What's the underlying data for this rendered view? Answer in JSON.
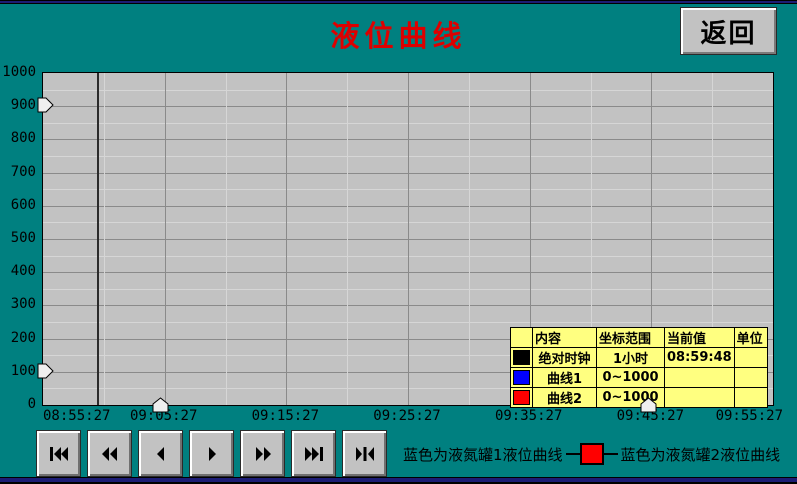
{
  "header": {
    "title": "液位曲线",
    "back_button": "返回",
    "title_color": "#dd0000"
  },
  "chart_data": {
    "type": "line",
    "title": "液位曲线",
    "xlabel": "",
    "ylabel": "",
    "ylim": [
      0,
      1000
    ],
    "y_ticks": [
      0,
      100,
      200,
      300,
      400,
      500,
      600,
      700,
      800,
      900,
      1000
    ],
    "y_minor_step": 50,
    "x_ticks": [
      "08:55:27",
      "09:05:27",
      "09:15:27",
      "09:25:27",
      "09:35:27",
      "09:45:27",
      "09:55:27"
    ],
    "grid": true,
    "legend_position": "bottom",
    "series": [
      {
        "name": "曲线1",
        "color": "#0000ff",
        "range": "0~1000",
        "values": []
      },
      {
        "name": "曲线2",
        "color": "#ff0000",
        "range": "0~1000",
        "values": []
      }
    ],
    "cursor_frac": 0.074,
    "y_handle_values": [
      900,
      100
    ],
    "x_handle_fracs": [
      0.162,
      0.83
    ],
    "colors": {
      "plot_bg": "#c2c2c2",
      "grid_major": "#8a8a8a",
      "grid_minor": "#d6d6d6",
      "cursor": "#2b2b2b",
      "background": "#008080"
    }
  },
  "table": {
    "headers": [
      "",
      "内容",
      "坐标范围",
      "当前值",
      "单位"
    ],
    "rows": [
      {
        "swatch": "#000000",
        "content": "绝对时钟",
        "range": "1小时",
        "current": "08:59:48",
        "unit": ""
      },
      {
        "swatch": "#0000ff",
        "content": "曲线1",
        "range": "0~1000",
        "current": "",
        "unit": ""
      },
      {
        "swatch": "#ff0000",
        "content": "曲线2",
        "range": "0~1000",
        "current": "",
        "unit": ""
      }
    ]
  },
  "nav_buttons": [
    {
      "name": "skip-to-start",
      "icon": "bar-double-left-icon"
    },
    {
      "name": "fast-backward",
      "icon": "double-left-icon"
    },
    {
      "name": "step-backward",
      "icon": "left-icon"
    },
    {
      "name": "step-forward",
      "icon": "right-icon"
    },
    {
      "name": "fast-forward",
      "icon": "double-right-icon"
    },
    {
      "name": "skip-to-end",
      "icon": "double-right-bar-icon"
    },
    {
      "name": "jump-to-cursor",
      "icon": "right-bar-left-icon"
    }
  ],
  "legend": {
    "curve1_text": "蓝色为液氮罐1液位曲线",
    "curve2_text": "蓝色为液氮罐2液位曲线",
    "marker_color": "#ff0000"
  }
}
